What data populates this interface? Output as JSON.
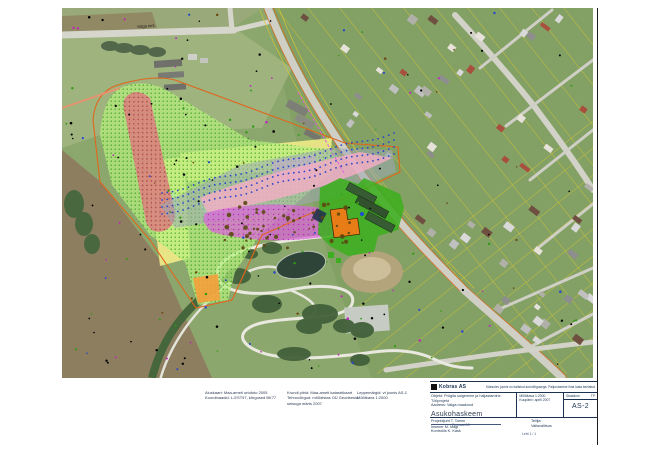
{
  "colors": {
    "zone_green": "#b7ef7f",
    "hatch_green": "#2f9a12",
    "zone_red": "#dd7f7f",
    "dot_red": "#a23b3b",
    "zone_yellow": "#f7f08a",
    "zone_pink": "#f5aec6",
    "zone_magenta": "#dd63dd",
    "dot_magenta": "#bb1fbb",
    "zone_lightblue": "#a8d8ee",
    "zone_gray": "#9fa9b4",
    "zone_lavender": "#c3a4da",
    "zone_orange": "#f5a03c",
    "envelope_orange": "#e0661c",
    "facility_green": "#3cae1f",
    "building_orange": "#e87d18",
    "contour_blue": "#2847c8",
    "parcel_yellow": "#d6c832",
    "water": "#2e4438",
    "ink": "#1b3350"
  },
  "map": {
    "road_label": "Valga mnt"
  },
  "notes": {
    "block1": {
      "line1": "Aluskaart: Maa-ameti ortofoto 2005",
      "line2": "Koordinaadid: L-EST97, kõrgused BK77"
    },
    "block2": {
      "line1": "Krundi piirid: Maa-ameti katastrikaart",
      "line2": "Tehnovõrgud: mõõdistas OÜ Geodeesia",
      "line3": "seisuga märts 2007"
    },
    "block3": {
      "line1": "Leppemärgid: vt joonis AS-1",
      "line2": "Mõõtkava 1:2000"
    }
  },
  "title_block": {
    "logo_text": "Kobras AS",
    "top_note": "Käesolev joonis on kaitstud autoriõigusega. Paljundamine ilma loata keelatud",
    "object_line1": "Objekt: Prügila sulgemine ja haljastamine. Tööprojekt",
    "object_line2": "Aadress: Valga maakond",
    "mid_line1": "Mõõtkava 1:2000",
    "mid_line2": "Kuupäev: aprill 2007",
    "stage_label": "Staadium",
    "stage_value": "TP",
    "main_title": "Asukohaskeem",
    "drawing_no": "AS-2",
    "author_line1": "Projektijuht   T. Tamm",
    "author_line2": "Insener   M. Mägi",
    "author_line3": "Kontrollis   K. Kask",
    "client_label": "Tellija:",
    "client_value": "Vallavalitsus",
    "note_small": "Formaat A3",
    "sheet_note": "Leht 1 / 1"
  }
}
